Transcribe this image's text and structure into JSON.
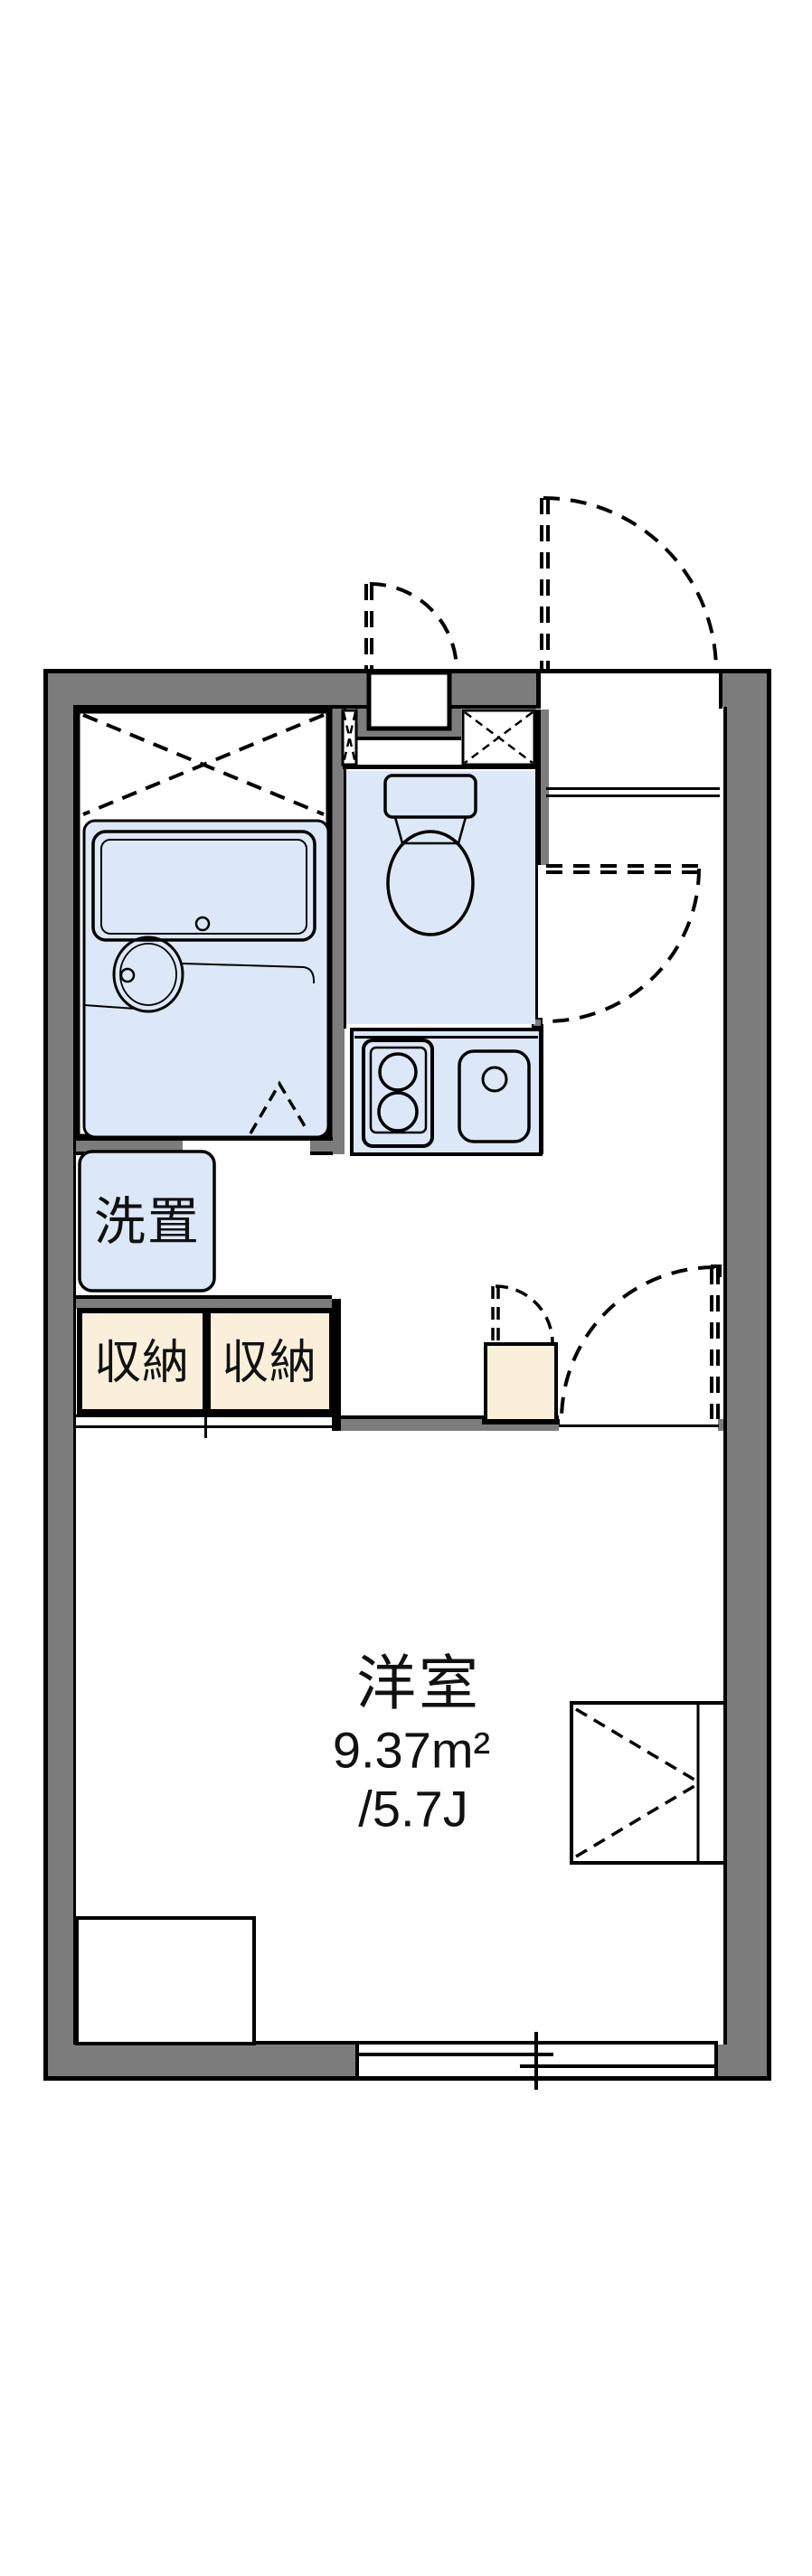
{
  "floorplan": {
    "labels": {
      "laundry": "洗置",
      "storage_left": "収納",
      "storage_right": "収納",
      "room_name": "洋室",
      "room_area_m2": "9.37m²",
      "room_area_tatami": "/5.7J"
    },
    "colors": {
      "wall": "#7c7c7c",
      "wet_floor": "#dce8f8",
      "storage_fill": "#f9efda",
      "line": "#000000",
      "background": "#ffffff"
    }
  }
}
